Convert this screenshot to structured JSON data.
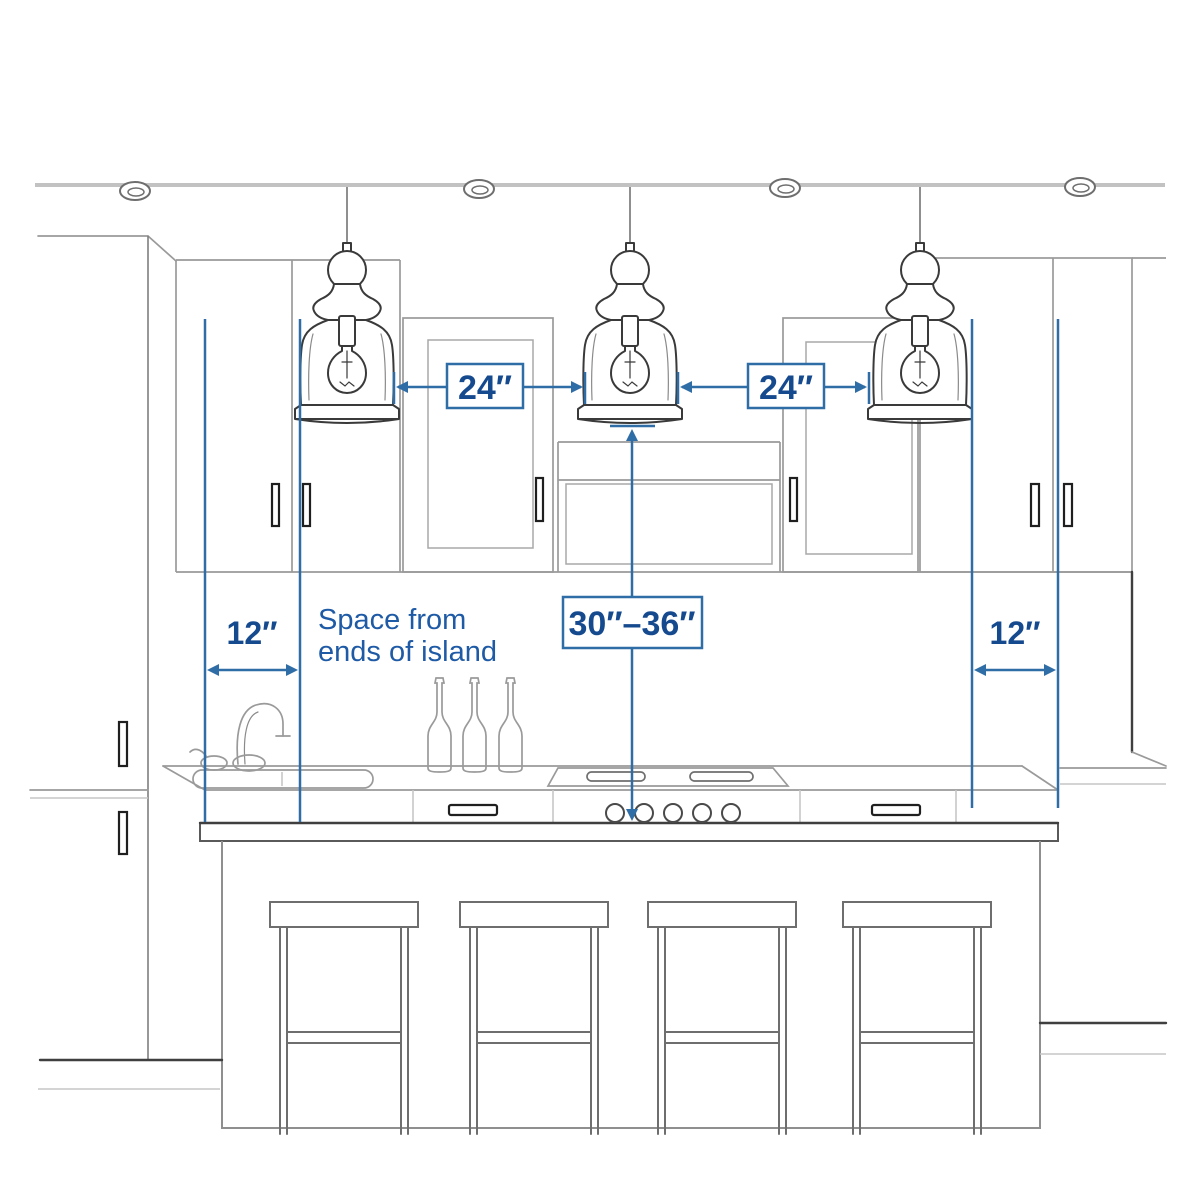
{
  "figure": {
    "title": "kitchen island pendant lighting spacing diagram",
    "background": "#ffffff",
    "accent_color": "#2e6da6",
    "label_color": "#164a8f",
    "sketch_color": "#3a3a3a"
  },
  "annotations": {
    "pendant_gap_left": "24″",
    "pendant_gap_right": "24″",
    "island_end_left": "12″",
    "island_end_right": "12″",
    "pendant_height_range": "30″–36″",
    "note_line1": "Space from",
    "note_line2": "ends of island"
  }
}
